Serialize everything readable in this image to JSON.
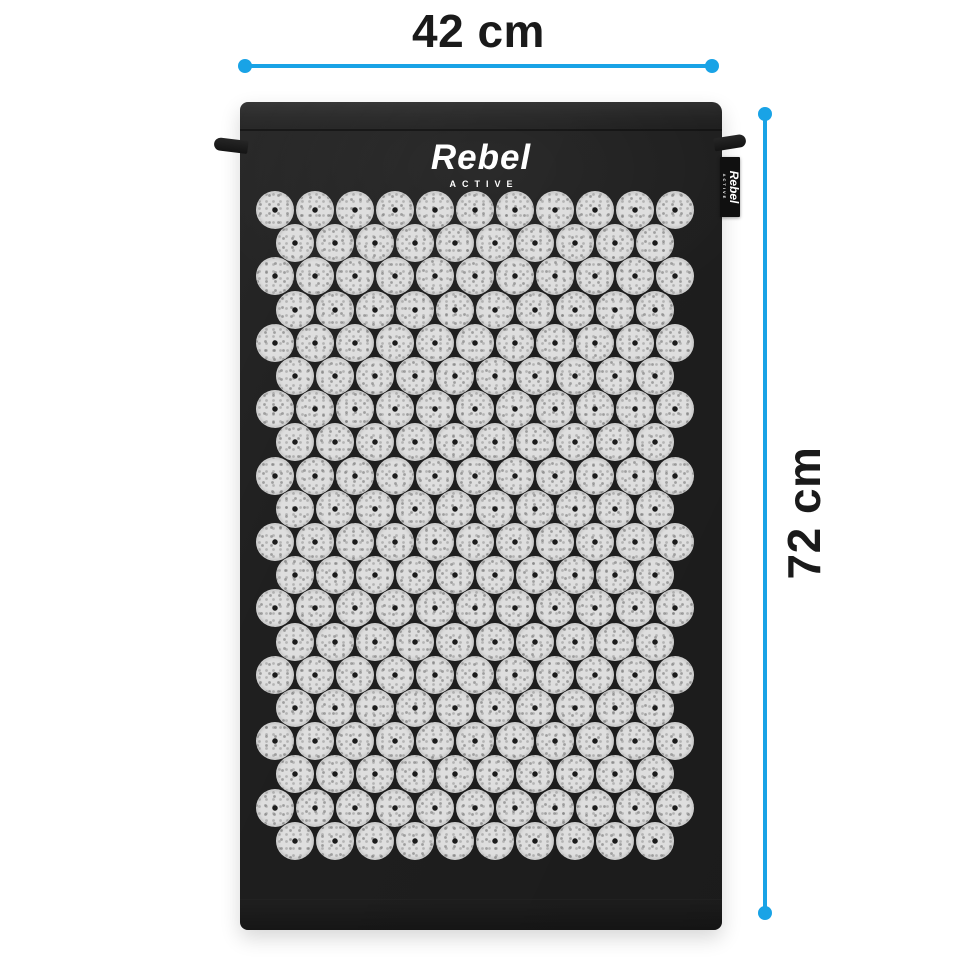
{
  "page": {
    "background_color": "#ffffff"
  },
  "dimension_annotations": {
    "line_color": "#19a3e6",
    "label_color": "#1a1a1a",
    "width": {
      "label": "42 cm"
    },
    "height": {
      "label": "72 cm"
    }
  },
  "mat": {
    "fabric_color": "#1f1f1f",
    "logo": {
      "brand": "Rebel",
      "subtitle": "ACTIVE",
      "color": "#ffffff"
    },
    "hang_tag": {
      "brand": "Rebel",
      "subtitle": "ACTIVE",
      "background": "#101010",
      "text_color": "#ffffff"
    },
    "spike_grid": {
      "rows": 20,
      "discs_per_odd_row": 11,
      "discs_per_even_row": 10,
      "disc_diameter": 38,
      "pitch_x": 40,
      "pitch_y": 33.2,
      "start_x": 35,
      "start_y": 108,
      "even_row_offset_x": 20,
      "disc_color": "#dedede",
      "disc_speckle_color": "#8a8a8a",
      "disc_center_dot_color": "#1b1b1b"
    }
  }
}
